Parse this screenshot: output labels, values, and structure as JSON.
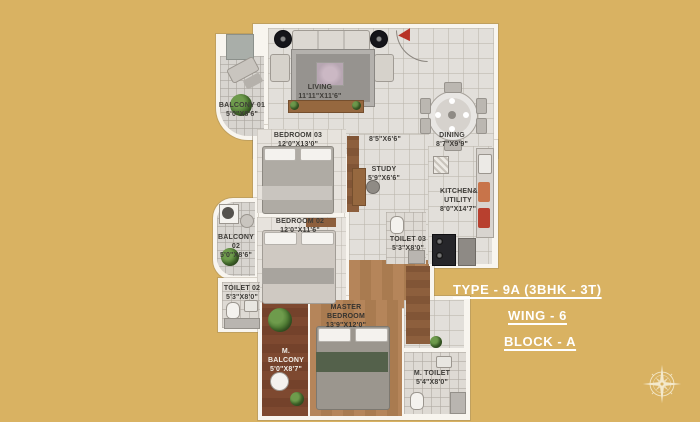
{
  "background_color": "#D9B262",
  "colors": {
    "wall": "#F8F5EF",
    "tile_floor": "#E2DFDA",
    "wood_floor": "#B5855A",
    "dark_wood_floor": "#7E4930",
    "accent_red": "#B83226",
    "annotation_text": "#FFFFFF",
    "compass": "#F4E9CC"
  },
  "annotation": {
    "type_label": "TYPE - 9A (3BHK - 3T)",
    "wing_label": "WING -  6",
    "block_label": "BLOCK -  A"
  },
  "icons": {
    "compass": "compass-rose-icon",
    "entry_marker": "entry-arrow-icon"
  },
  "rooms": [
    {
      "name": "BALCONY 01",
      "dim": "5'0\"X8'6\""
    },
    {
      "name": "LIVING",
      "dim": "11'11\"X11'6\""
    },
    {
      "name": "BEDROOM 03",
      "dim": "12'0\"X13'0\""
    },
    {
      "name": "",
      "dim": "8'5\"X6'6\""
    },
    {
      "name": "DINING",
      "dim": "8'7\"X9'9\""
    },
    {
      "name": "STUDY",
      "dim": "5'9\"X6'6\""
    },
    {
      "name": "KITCHEN& UTILITY",
      "dim": "8'0\"X14'7\""
    },
    {
      "name": "TOILET 03",
      "dim": "5'3\"X8'0\""
    },
    {
      "name": "BEDROOM 02",
      "dim": "12'0\"X11'6\""
    },
    {
      "name": "BALCONY 02",
      "dim": "5'0\"X8'6\""
    },
    {
      "name": "TOILET 02",
      "dim": "5'3\"X8'0\""
    },
    {
      "name": "M. BALCONY",
      "dim": "5'0\"X8'7\""
    },
    {
      "name": "MASTER BEDROOM",
      "dim": "13'9\"X12'0\""
    },
    {
      "name": "M. TOILET",
      "dim": "5'4\"X8'0\""
    }
  ]
}
